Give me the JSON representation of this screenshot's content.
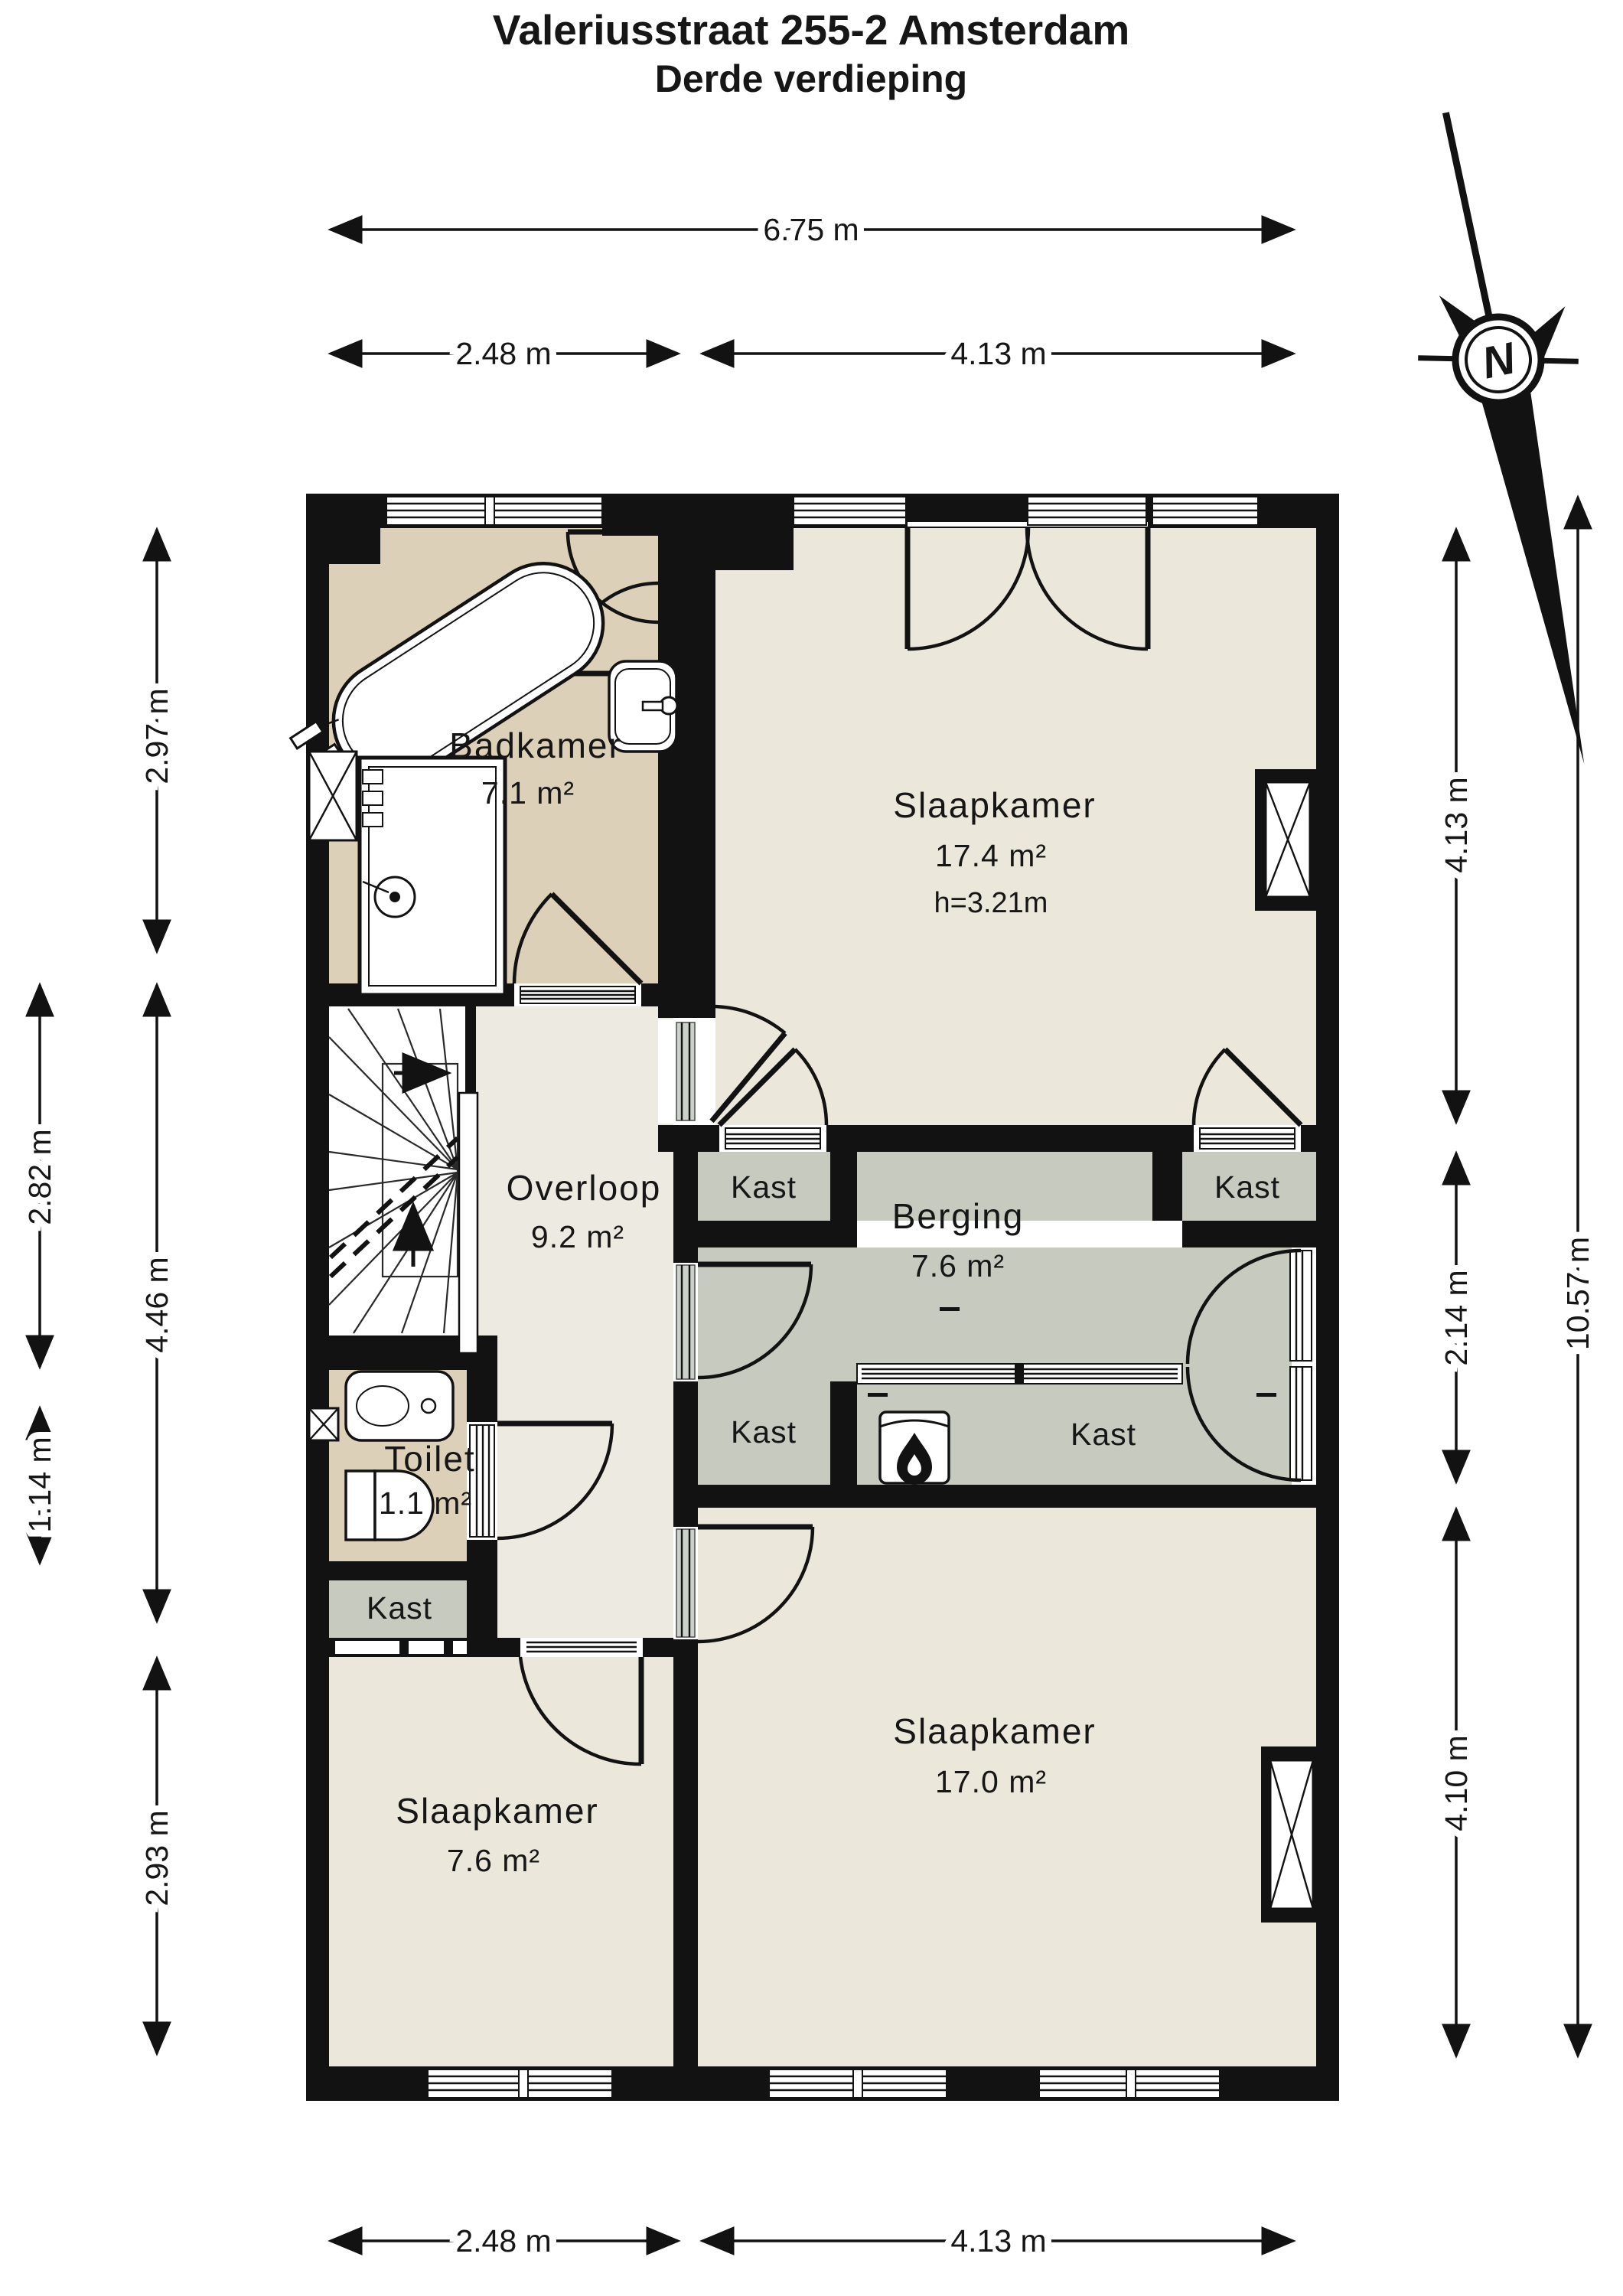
{
  "title": {
    "line1": "Valeriusstraat 255-2 Amsterdam",
    "line2": "Derde verdieping"
  },
  "compass": {
    "north_label": "N"
  },
  "rooms": {
    "badkamer": {
      "name": "Badkamer",
      "area": "7.1 m²"
    },
    "slaapkamer_top": {
      "name": "Slaapkamer",
      "area": "17.4 m²",
      "ceiling": "h=3.21m"
    },
    "overloop": {
      "name": "Overloop",
      "area": "9.2 m²"
    },
    "berging": {
      "name": "Berging",
      "area": "7.6 m²"
    },
    "toilet": {
      "name": "Toilet",
      "area": "1.1 m²"
    },
    "slaapkamer_left": {
      "name": "Slaapkamer",
      "area": "7.6 m²"
    },
    "slaapkamer_right": {
      "name": "Slaapkamer",
      "area": "17.0 m²"
    }
  },
  "closets": {
    "top_left": "Kast",
    "top_right": "Kast",
    "lower_left": "Kast",
    "main": "Kast",
    "under_toilet": "Kast"
  },
  "dimensions": {
    "top_total": "6.75 m",
    "top_left": "2.48 m",
    "top_right": "4.13 m",
    "bottom_left": "2.48 m",
    "bottom_right": "4.13 m",
    "left_inner_top": "2.97 m",
    "left_inner_mid": "4.46 m",
    "left_inner_bottom": "2.93 m",
    "left_outer_top": "2.82 m",
    "left_outer_bottom": "1.14 m",
    "right_inner_top": "4.13 m",
    "right_inner_mid": "2.14 m",
    "right_inner_bottom": "4.10 m",
    "right_outer_total": "10.57 m"
  },
  "colors": {
    "wall": "#121212",
    "bedroom_floor": "#ebe8db",
    "bathroom_floor": "#ddd0b8",
    "hall_floor": "#edebe1",
    "storage_floor": "#c7cabf",
    "stair_floor": "#ffffff"
  }
}
